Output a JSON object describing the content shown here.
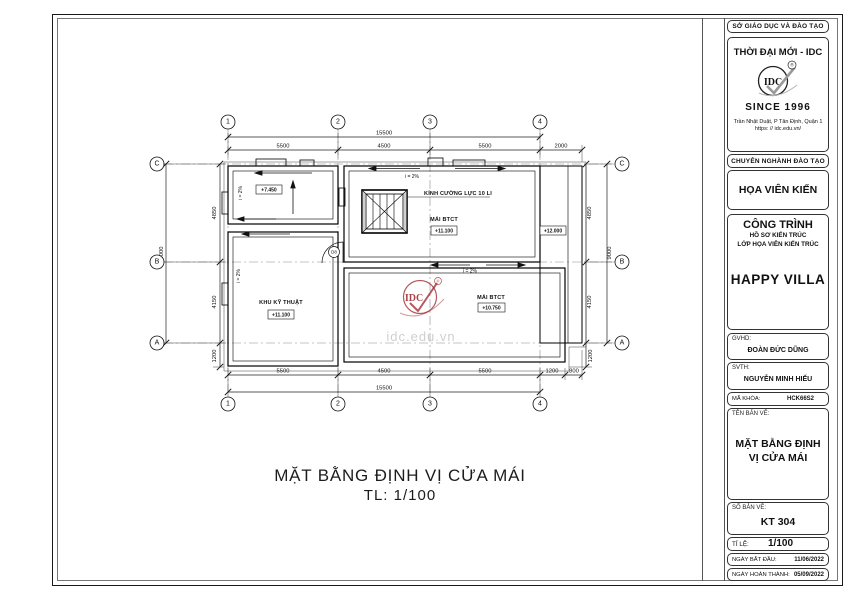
{
  "plan": {
    "grid": {
      "cols": [
        "1",
        "2",
        "3",
        "4"
      ],
      "rows": [
        "C",
        "B",
        "A"
      ]
    },
    "dims": {
      "top_overall": "15500",
      "top": [
        "5500",
        "4500",
        "5500",
        "2000"
      ],
      "bottom": [
        "5500",
        "4500",
        "5500",
        "1200",
        "800"
      ],
      "bottom_overall": "15500",
      "left": [
        "4850",
        "4150",
        "1200"
      ],
      "left_overall": "9000",
      "right": [
        "4850",
        "4150",
        "1200"
      ],
      "right_overall": "9000"
    },
    "labels": {
      "skylight_note": "KÍNH CƯỜNG LỰC 10 LI",
      "level_terrace": "+7.450",
      "mai_btct": "MÁI BTCT",
      "level_mid": "+11.100",
      "tech_room": "KHU KỸ THUẬT",
      "level_tech": "+11.100",
      "level_low": "+10.750",
      "level_strip": "+12.000",
      "slope": "i = 2%",
      "door_tag": "D8"
    },
    "title": "MẶT BẰNG ĐỊNH VỊ CỬA  MÁI",
    "scale": "TL:  1/100"
  },
  "watermark": {
    "logo": "IDC",
    "site": "idc.edu.vn"
  },
  "title_block": {
    "dept": "SỞ GIÁO DỤC VÀ ĐÀO TẠO",
    "brand": "THỜI ĐẠI MỚI - IDC",
    "logo_text": "IDC",
    "reg_mark": "®",
    "since": "SINCE 1996",
    "address_line1": "Trần Nhật Duật, P Tân Định, Quận 1",
    "address_line2": "https: // idc.edu.vn/",
    "major_header": "CHUYÊN NGHÀNH ĐÀO TẠO",
    "major": "HỌA VIÊN KIẾN TRÚC",
    "project_header": "CÔNG TRÌNH",
    "project_sub1": "HỒ SƠ KIẾN TRÚC",
    "project_sub2": "LỚP HỌA VIÊN KIẾN TRÚC",
    "project_name": "HAPPY VILLA",
    "gvhd_label": "GVHD:",
    "gvhd": "ĐOÀN ĐỨC DŨNG",
    "svth_label": "SVTH:",
    "svth": "NGUYỄN MINH HIẾU",
    "code_label": "MÃ KHÓA:",
    "code": "HCK66S2",
    "drawing_name_label": "TÊN BẢN VẼ:",
    "drawing_name": "MẶT BẰNG ĐỊNH VỊ CỬA MÁI",
    "sheet_no_label": "SỐ BẢN VẼ:",
    "sheet_no": "KT 304",
    "scale_label": "TỈ LỆ:",
    "scale": "1/100",
    "start_label": "NGÀY BẮT ĐẦU:",
    "start_date": "11/06/2022",
    "end_label": "NGÀY HOÀN THÀNH:",
    "end_date": "05/09/2022"
  }
}
